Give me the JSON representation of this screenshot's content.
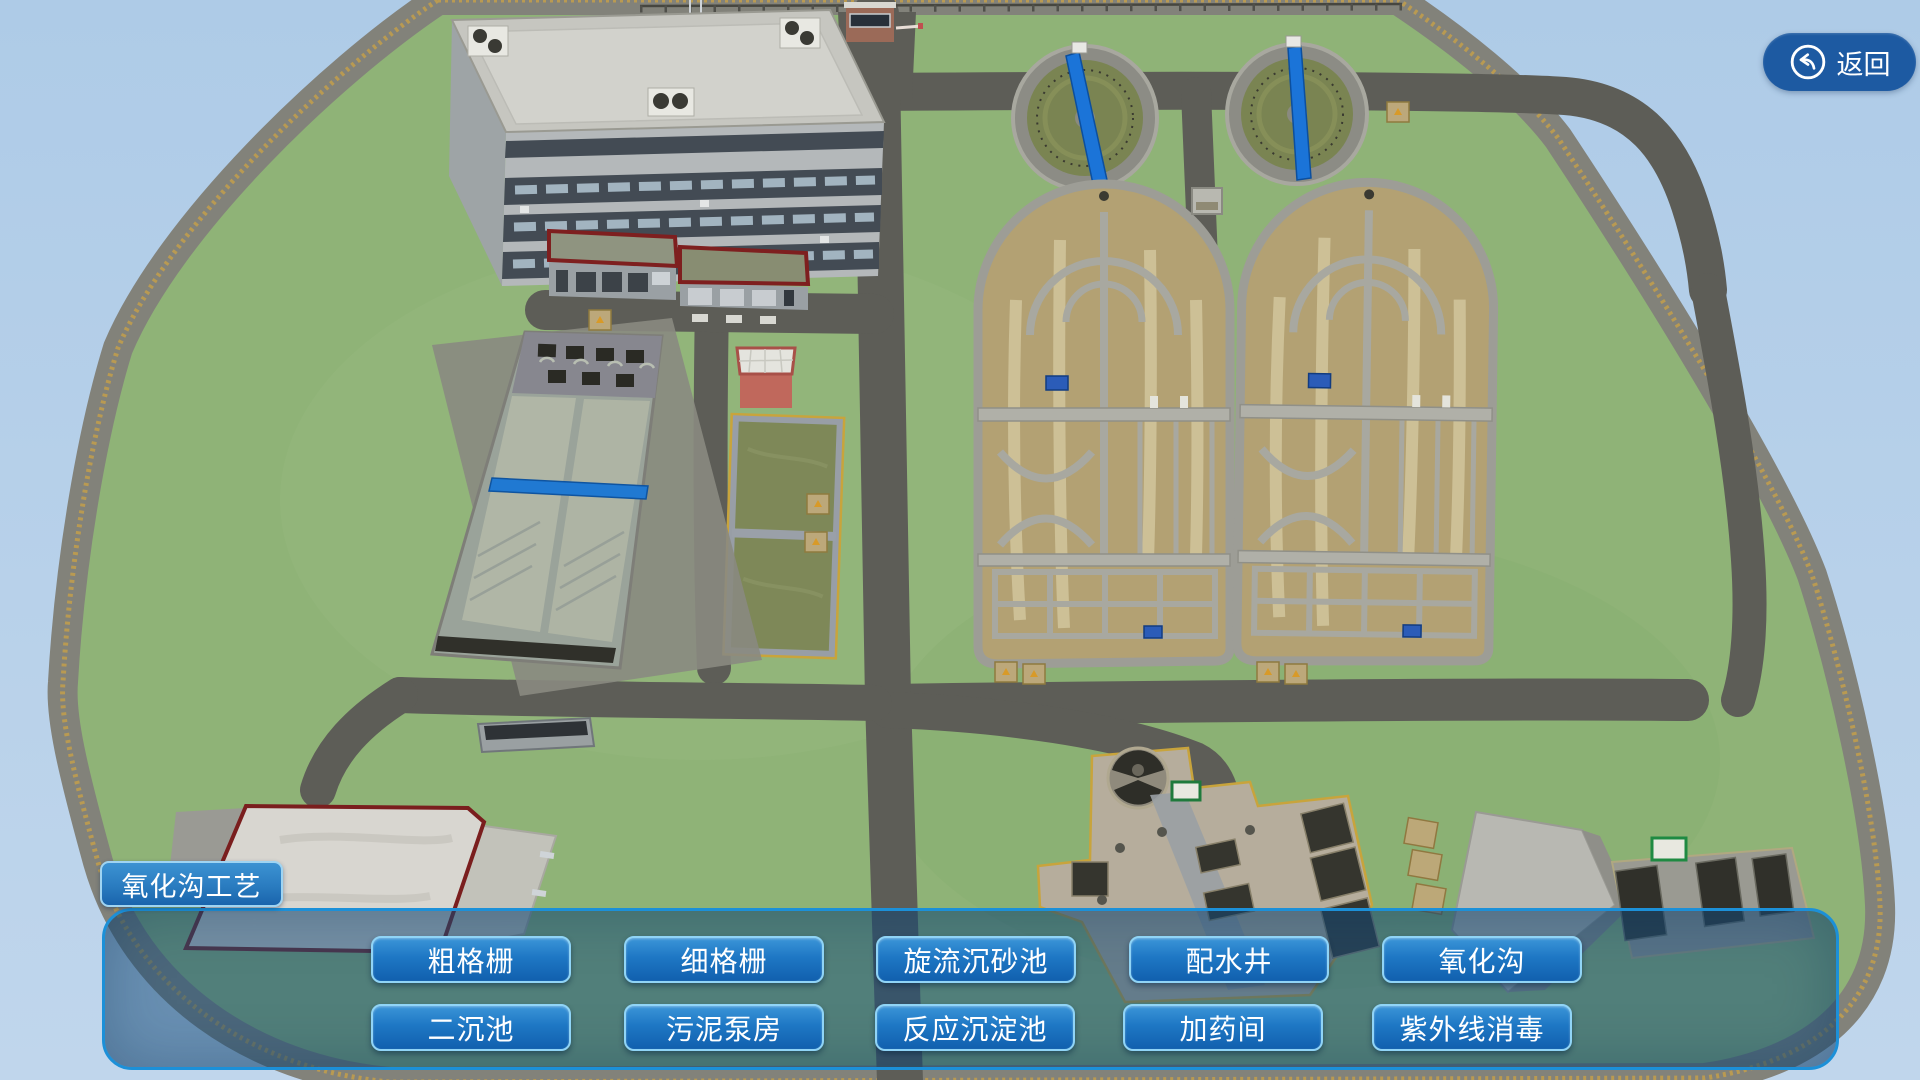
{
  "ui": {
    "back_button": {
      "label": "返回",
      "icon": "return-arrow-icon"
    },
    "process_label": "氧化沟工艺",
    "process_buttons_row1": [
      "粗格栅",
      "细格栅",
      "旋流沉砂池",
      "配水井",
      "氧化沟"
    ],
    "process_buttons_row2": [
      "二沉池",
      "污泥泵房",
      "反应沉淀池",
      "加药间",
      "紫外线消毒"
    ]
  },
  "colors": {
    "sky": "#b3cfe8",
    "grass": "#8fb377",
    "road": "#5d5d57",
    "perimeter_berm": "#82827a",
    "fence": "#b99a52",
    "clarifier_water": "#7a8452",
    "oxidation_ditch_sand": "#b3a173",
    "concrete_wall": "#a8a8a0",
    "bridge_blue": "#1b74d8",
    "panel_border": "#1c90d8",
    "panel_fill": "rgba(24,78,124,0.52)",
    "button_gradient_top": "#3b95d8",
    "button_gradient_bottom": "#1160ae",
    "button_border": "#90d4f6",
    "back_button_fill": "#1d5aa2",
    "label_gradient_top": "#3c92d2",
    "label_gradient_bottom": "#1a64ac"
  }
}
